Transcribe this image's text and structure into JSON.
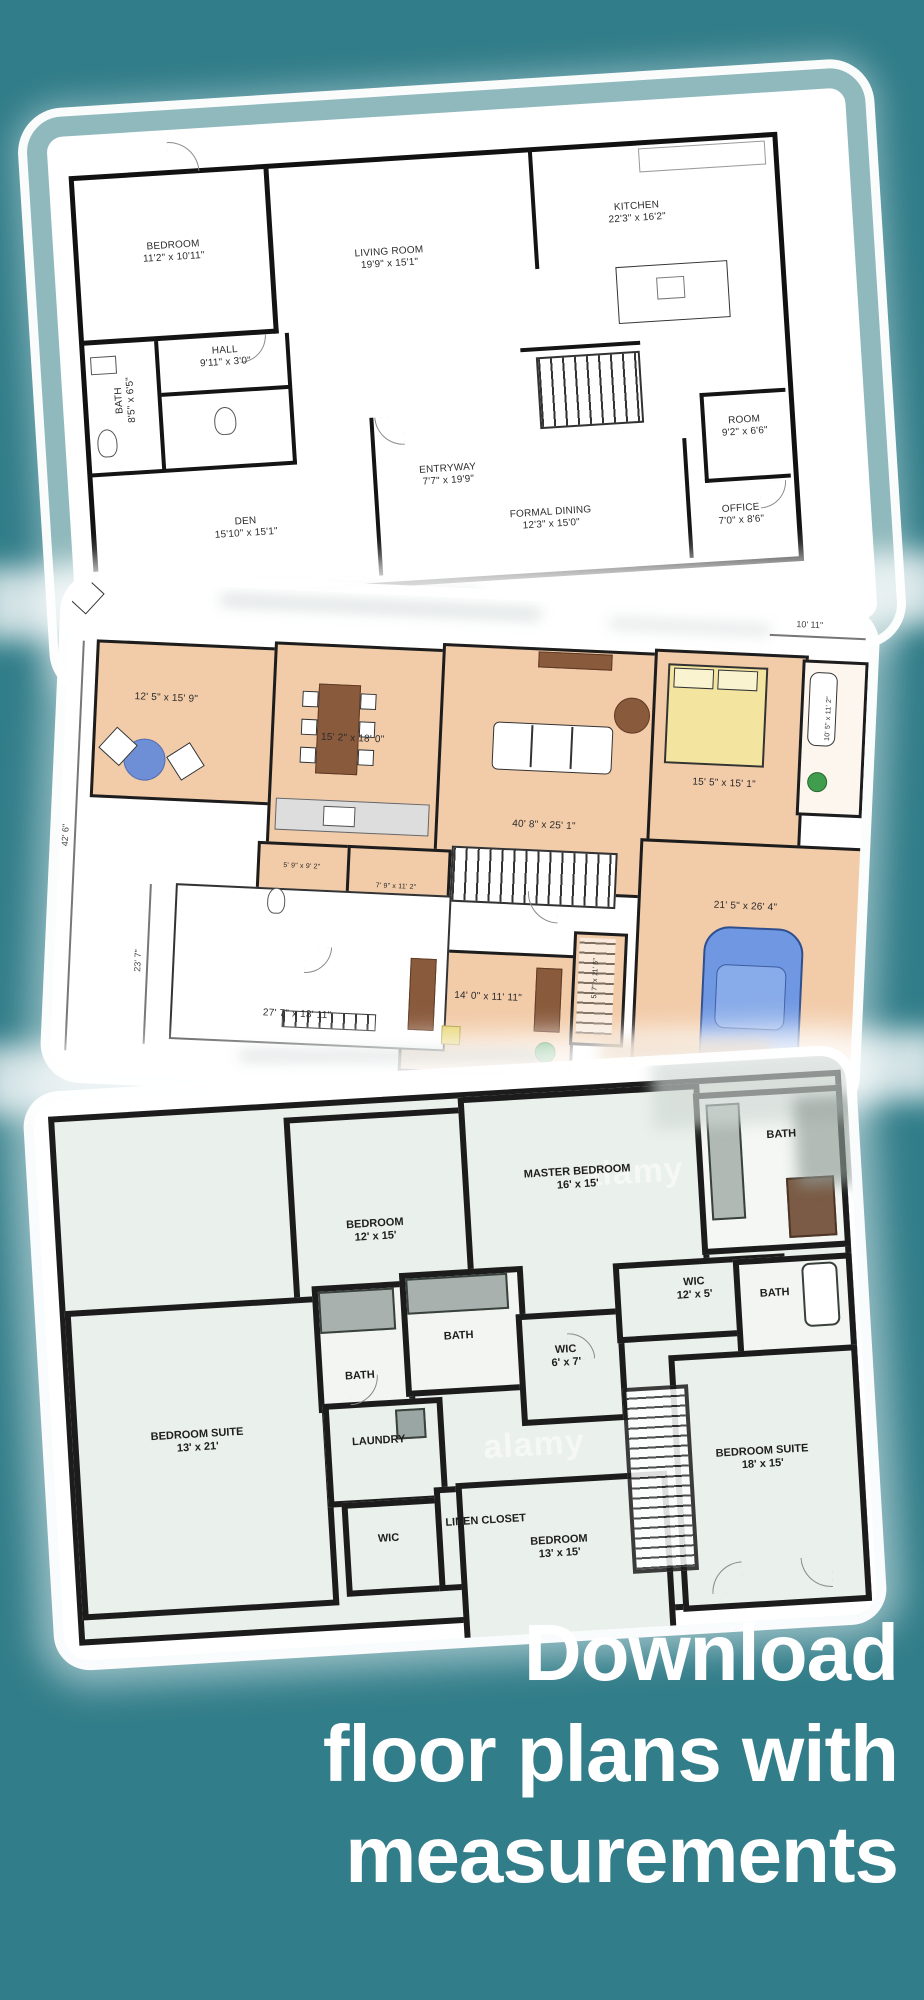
{
  "colors": {
    "background": "#317D89",
    "card_border_band": "#8FB9BC",
    "plan2_floor": "#F2CBA8",
    "plan3_floor": "#EAF0EB",
    "headline_text": "#FFFFFF"
  },
  "headline": {
    "lines": [
      "Download",
      "floor plans with",
      "measurements"
    ]
  },
  "plan1": {
    "rooms": {
      "bedroom": {
        "name": "BEDROOM",
        "dims": "11'2\" x 10'11\""
      },
      "living": {
        "name": "LIVING ROOM",
        "dims": "19'9\" x 15'1\""
      },
      "kitchen": {
        "name": "KITCHEN",
        "dims": "22'3\" x 16'2\""
      },
      "room": {
        "name": "ROOM",
        "dims": "9'2\" x 6'6\""
      },
      "hall": {
        "name": "HALL",
        "dims": "9'11\" x 3'0\""
      },
      "bath": {
        "name": "BATH",
        "dims": "8'5\" x 6'5\""
      },
      "entryway": {
        "name": "ENTRYWAY",
        "dims": "7'7\" x 19'9\""
      },
      "den": {
        "name": "DEN",
        "dims": "15'10\" x 15'1\""
      },
      "dining": {
        "name": "FORMAL DINING",
        "dims": "12'3\" x 15'0\""
      },
      "office": {
        "name": "OFFICE",
        "dims": "7'0\" x 8'6\""
      }
    }
  },
  "plan2": {
    "labels": {
      "room_a": "12' 5\" x 15' 9\"",
      "room_b": "15' 2\" x 18' 0\"",
      "great_room": "40' 8\" x 25' 1\"",
      "bedroom": "15' 5\" x 15' 1\"",
      "bath": "10' 5\" x 11' 2\"",
      "bath_small": "5' 9\" x 9' 2\"",
      "room_small": "7' 9\" x 11' 2\"",
      "office": "14' 0\" x 11' 11\"",
      "closet": "5' 7\" x 11' 5\"",
      "garage": "21' 5\" x 26' 4\"",
      "porch": "27' 7\" x 13' 11\""
    },
    "dims": {
      "width": "42' 6\"",
      "height": "23' 7\"",
      "top": "10' 11\""
    }
  },
  "plan3": {
    "rooms": {
      "bedroom1": {
        "name": "BEDROOM",
        "dims": "12' x 15'"
      },
      "master": {
        "name": "MASTER BEDROOM",
        "dims": "16' x 15'"
      },
      "bath_top": {
        "name": "BATH"
      },
      "bath_l1": {
        "name": "BATH"
      },
      "bath_l2": {
        "name": "BATH"
      },
      "wic_center": {
        "name": "WIC",
        "dims": "6' x 7'"
      },
      "wic_right": {
        "name": "WIC",
        "dims": "12' x 5'"
      },
      "bath_right": {
        "name": "BATH"
      },
      "suite_left": {
        "name": "BEDROOM SUITE",
        "dims": "13' x 21'"
      },
      "laundry": {
        "name": "LAUNDRY"
      },
      "wic_small": {
        "name": "WIC"
      },
      "linen": {
        "name": "LINEN CLOSET"
      },
      "bedroom2": {
        "name": "BEDROOM",
        "dims": "13' x 15'"
      },
      "suite_right": {
        "name": "BEDROOM SUITE",
        "dims": "18' x 15'"
      }
    },
    "watermark": "alamy"
  }
}
